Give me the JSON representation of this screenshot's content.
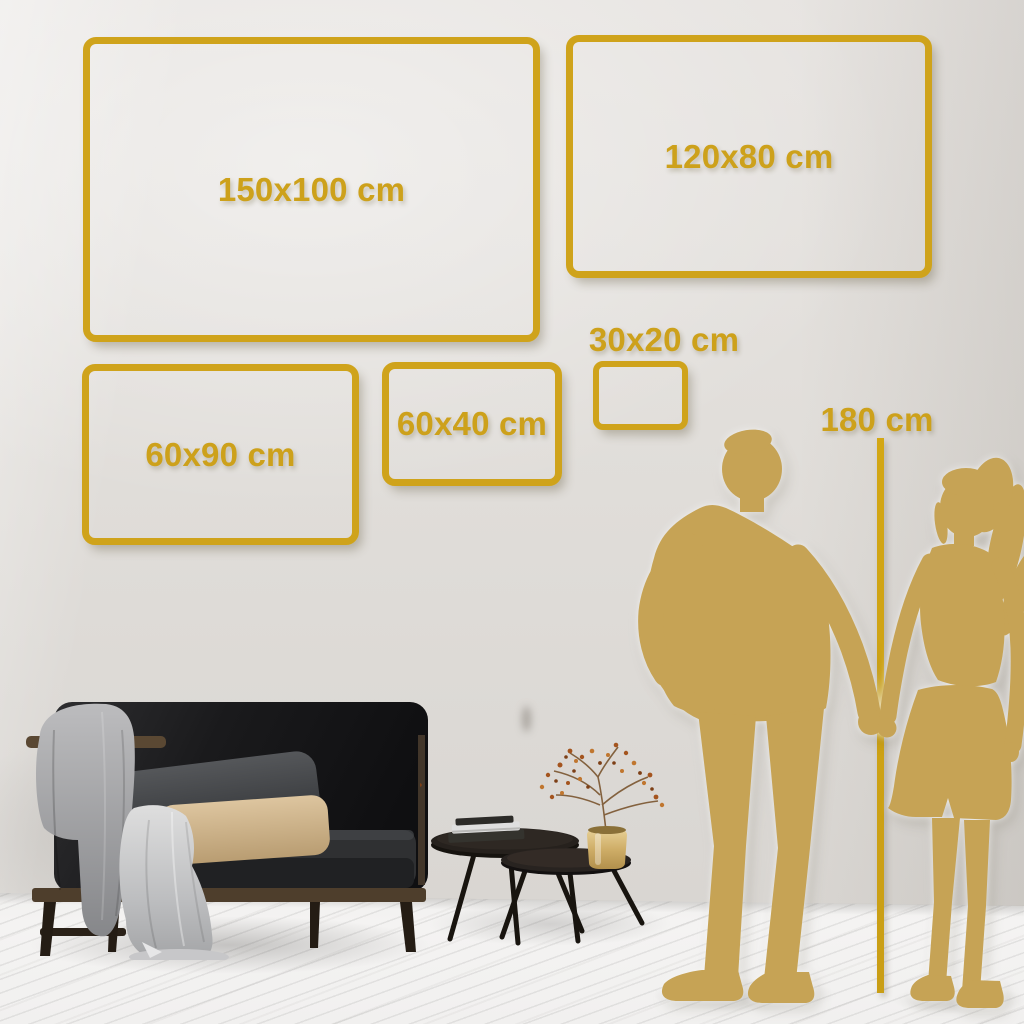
{
  "size_guide": {
    "frames": [
      {
        "id": "150x100",
        "label": "150x100 cm"
      },
      {
        "id": "120x80",
        "label": "120x80 cm"
      },
      {
        "id": "60x90",
        "label": "60x90 cm"
      },
      {
        "id": "60x40",
        "label": "60x40 cm"
      },
      {
        "id": "30x20",
        "label": "30x20 cm"
      }
    ],
    "height_marker": {
      "label": "180 cm"
    }
  },
  "colors": {
    "accent_gold": "#CFA31B",
    "silhouette_gold": "#C6A355",
    "wall": "#E0DDD9",
    "floor": "#F3F2F1",
    "sofa": "#1E1E20",
    "wood": "#4E3E2C",
    "vase_brass": "#C9A45C",
    "pillow_beige": "#D8BF98"
  },
  "icons": {
    "man": "man-silhouette",
    "woman": "woman-silhouette"
  }
}
